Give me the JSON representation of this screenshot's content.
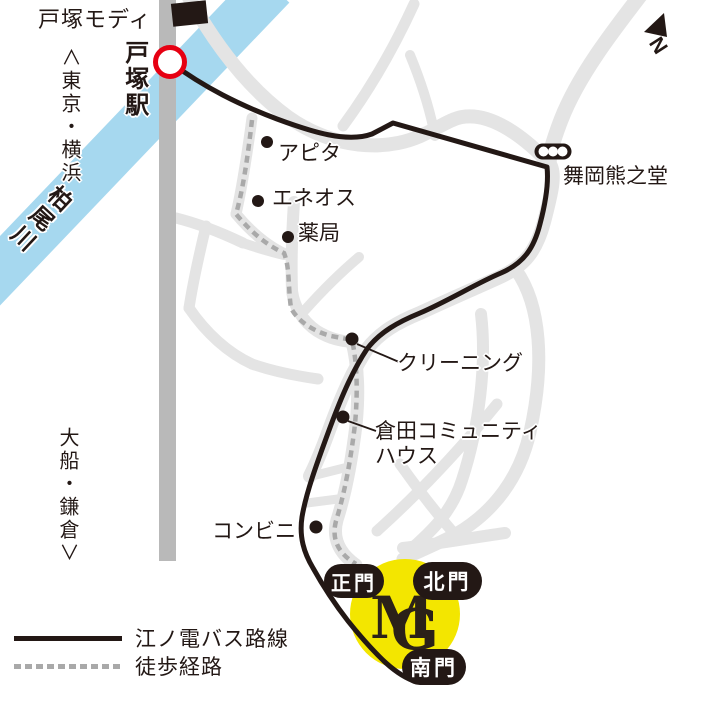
{
  "colors": {
    "ink": "#231815",
    "river": "#a6d8ef",
    "road": "#e4e4e4",
    "railway": "#b9b9b9",
    "walk_gray": "#a9a9a9",
    "station_red": "#e60012",
    "campus_yellow": "#f3e600"
  },
  "landmarks": {
    "totsuka_modi": "戸塚モディ",
    "totsuka_station": "戸塚駅",
    "to_tokyo_yokohama": "∧東京・横浜",
    "kashio_river": "柏尾川",
    "to_ofuna_kamakura": "大船・鎌倉∨",
    "apita": "アピタ",
    "eneos": "エネオス",
    "pharmacy": "薬局",
    "maioka_kumanodo": "舞岡熊之堂",
    "cleaning": "クリーニング",
    "kurata_community_house": "倉田コミュニティ\nハウス",
    "convenience_store": "コンビニ"
  },
  "gates": {
    "main_gate": "正門",
    "north_gate": "北門",
    "south_gate": "南門"
  },
  "campus_logo": {
    "letter_m": "M",
    "letter_g": "G"
  },
  "compass": {
    "north": "N"
  },
  "legend": {
    "bus_route": "江ノ電バス路線",
    "walking_route": "徒歩経路"
  }
}
